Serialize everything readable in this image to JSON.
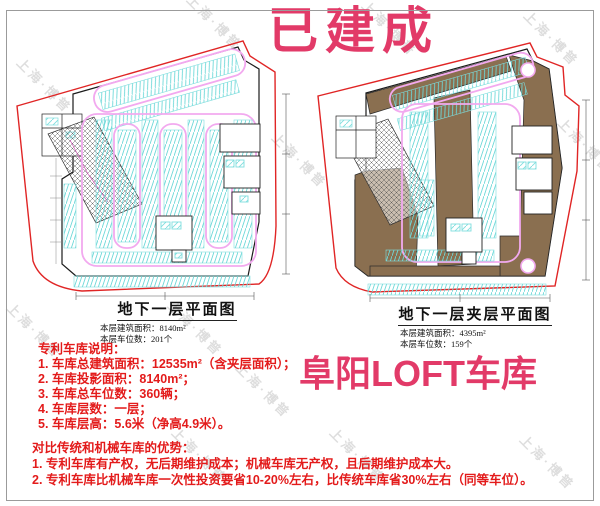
{
  "banner": {
    "built_label": "已建成",
    "project_label": "阜阳LOFT车库"
  },
  "watermark": {
    "text": "上海·博普",
    "positions": [
      [
        45,
        85
      ],
      [
        215,
        22
      ],
      [
        390,
        28
      ],
      [
        552,
        38
      ],
      [
        586,
        145
      ],
      [
        455,
        215
      ],
      [
        300,
        160
      ],
      [
        35,
        330
      ],
      [
        196,
        328
      ],
      [
        264,
        390
      ],
      [
        200,
        455
      ],
      [
        358,
        455
      ],
      [
        548,
        462
      ]
    ]
  },
  "plans": {
    "left": {
      "title": "地下一层平面图",
      "area_line": "本层建筑面积：8140m²",
      "spaces_line": "本层车位数：201个"
    },
    "right": {
      "title": "地下一层夹层平面图",
      "area_line": "本层建筑面积：4395m²",
      "spaces_line": "本层车位数：159个"
    }
  },
  "description": {
    "heading": "专利车库说明：",
    "items": [
      "1. 车库总建筑面积：12535m²（含夹层面积）；",
      "2. 车库投影面积：8140m²；",
      "3. 车库总车位数：360辆；",
      "4. 车库层数：一层；",
      "5. 车库层高：5.6米（净高4.9米）。"
    ]
  },
  "advantages": {
    "heading": "对比传统和机械车库的优势：",
    "items": [
      "1. 专利车库有产权，无后期维护成本；机械车库无产权，且后期维护成本大。",
      "2. 专利车库比机械车库一次性投资要省10-20%左右，比传统车库省30%左右（同等车位）。"
    ]
  },
  "colors": {
    "accent_pink": "#e23a68",
    "note_red": "#e31b1b",
    "mezzanine_brown": "#8a6f50",
    "stall_cyan": "#7fdede",
    "lane_pink": "#f2a9ef",
    "boundary_red": "#e02525",
    "watermark_gray": "#d9d9d9"
  }
}
